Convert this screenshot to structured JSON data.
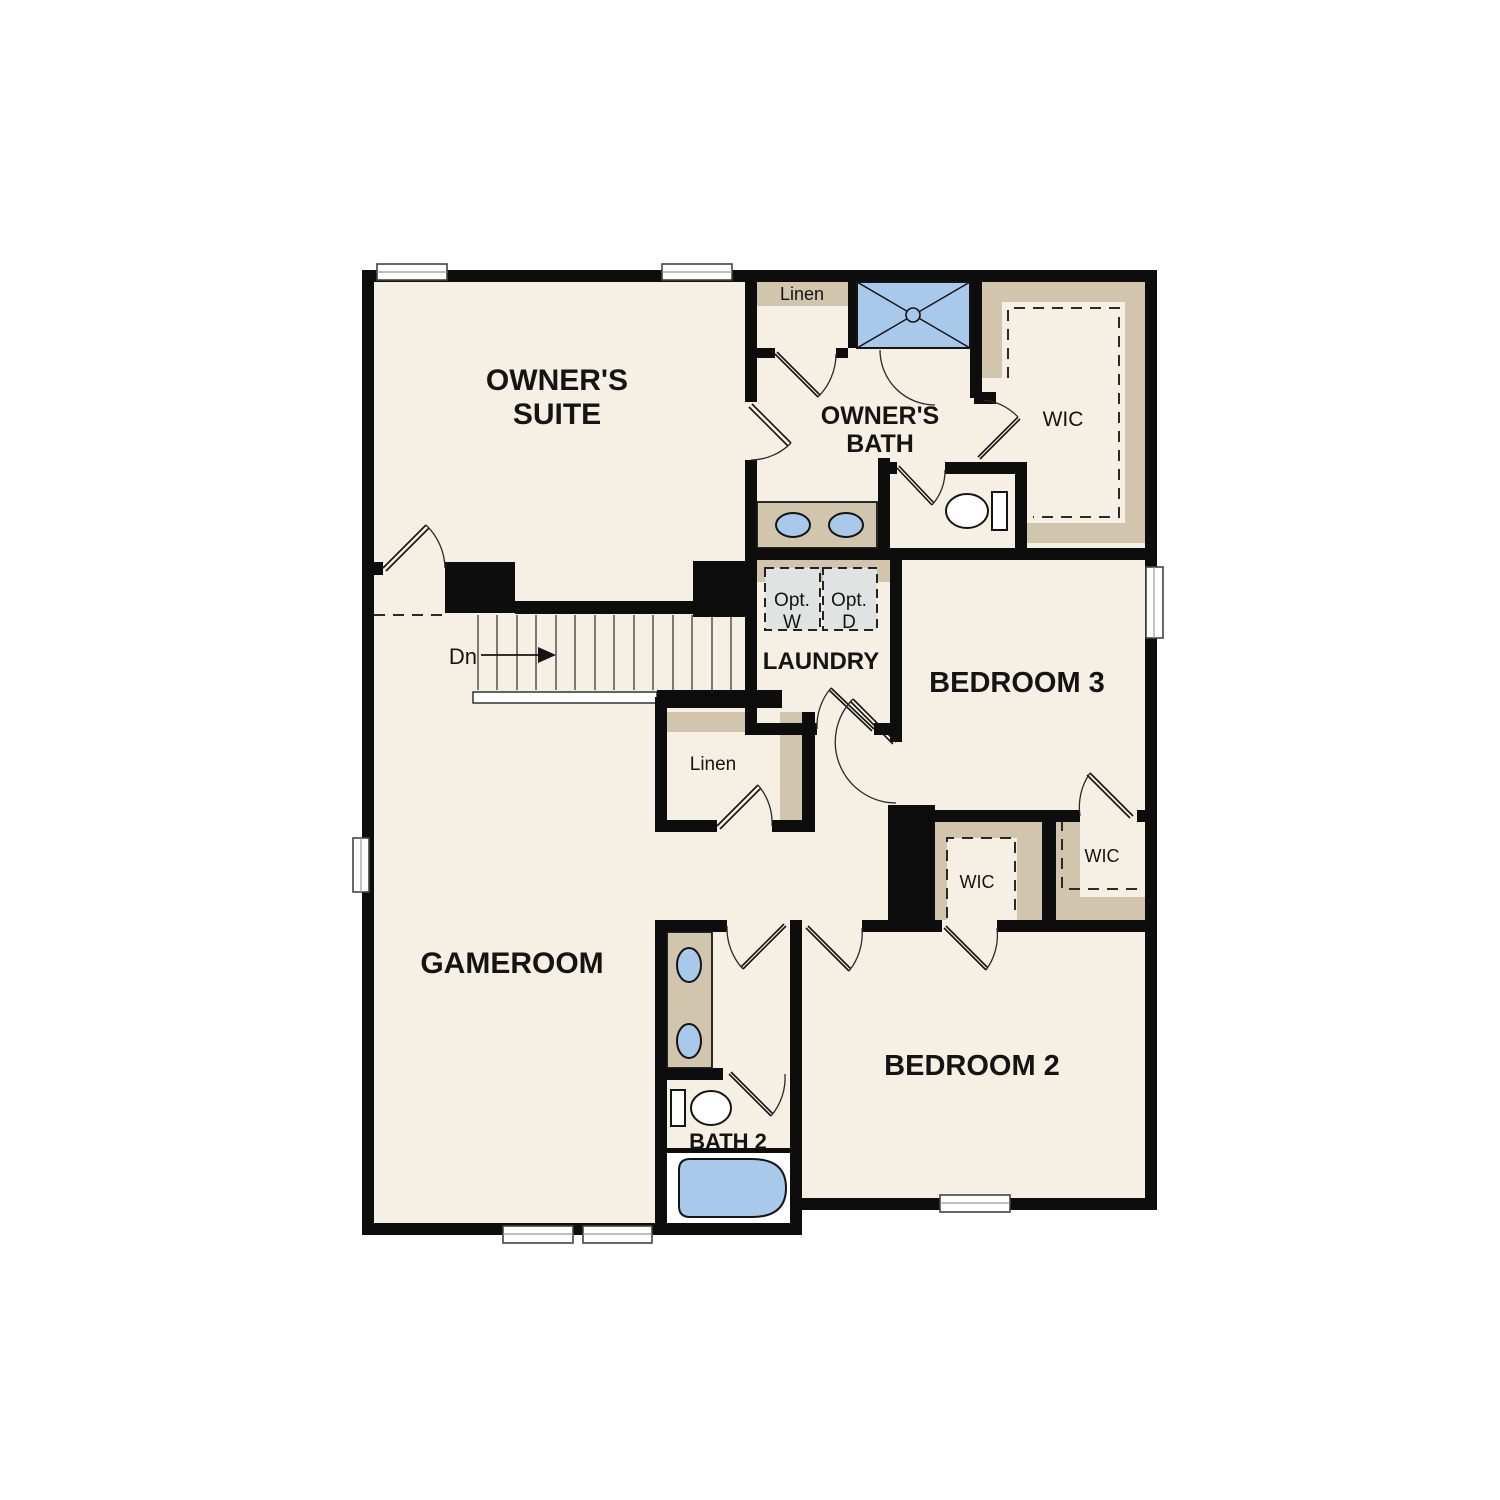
{
  "plan": {
    "rooms": {
      "owners_suite": {
        "line1": "OWNER'S",
        "line2": "SUITE"
      },
      "owners_bath": {
        "line1": "OWNER'S",
        "line2": "BATH"
      },
      "wic_owners": "WIC",
      "linen_top": "Linen",
      "laundry": "LAUNDRY",
      "bedroom3": "BEDROOM 3",
      "linen_mid": "Linen",
      "wic_bedroom2": "WIC",
      "wic_right": "WIC",
      "gameroom": "GAMEROOM",
      "bedroom2": "BEDROOM 2",
      "bath2": "BATH 2"
    },
    "stairs": {
      "direction_label": "Dn"
    },
    "laundry_options": {
      "washer": {
        "line1": "Opt.",
        "line2": "W"
      },
      "dryer": {
        "line1": "Opt.",
        "line2": "D"
      }
    },
    "colors": {
      "wall": "#0d0d0d",
      "floor": "#f6efe3",
      "casework": "#d2c5ad",
      "fixture_blue": "#a9c9ea",
      "optional_fill": "#dfe3e2"
    }
  }
}
